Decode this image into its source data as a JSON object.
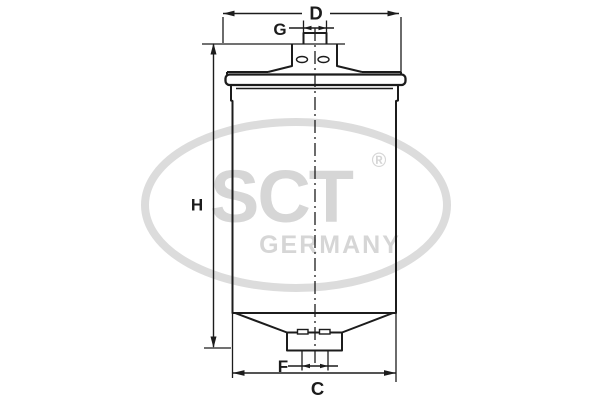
{
  "dimension_labels": {
    "diameter_top": "D",
    "port_top": "G",
    "height": "H",
    "port_bottom": "F",
    "diameter_body": "C"
  },
  "watermark": {
    "brand": "SCT",
    "registered_mark": "®",
    "country": "GERMANY"
  },
  "colors": {
    "line": "#1c1c1c",
    "watermark": "#d6d6d6",
    "watermark_ellipse": "#dcdcdc",
    "background": "#ffffff"
  }
}
